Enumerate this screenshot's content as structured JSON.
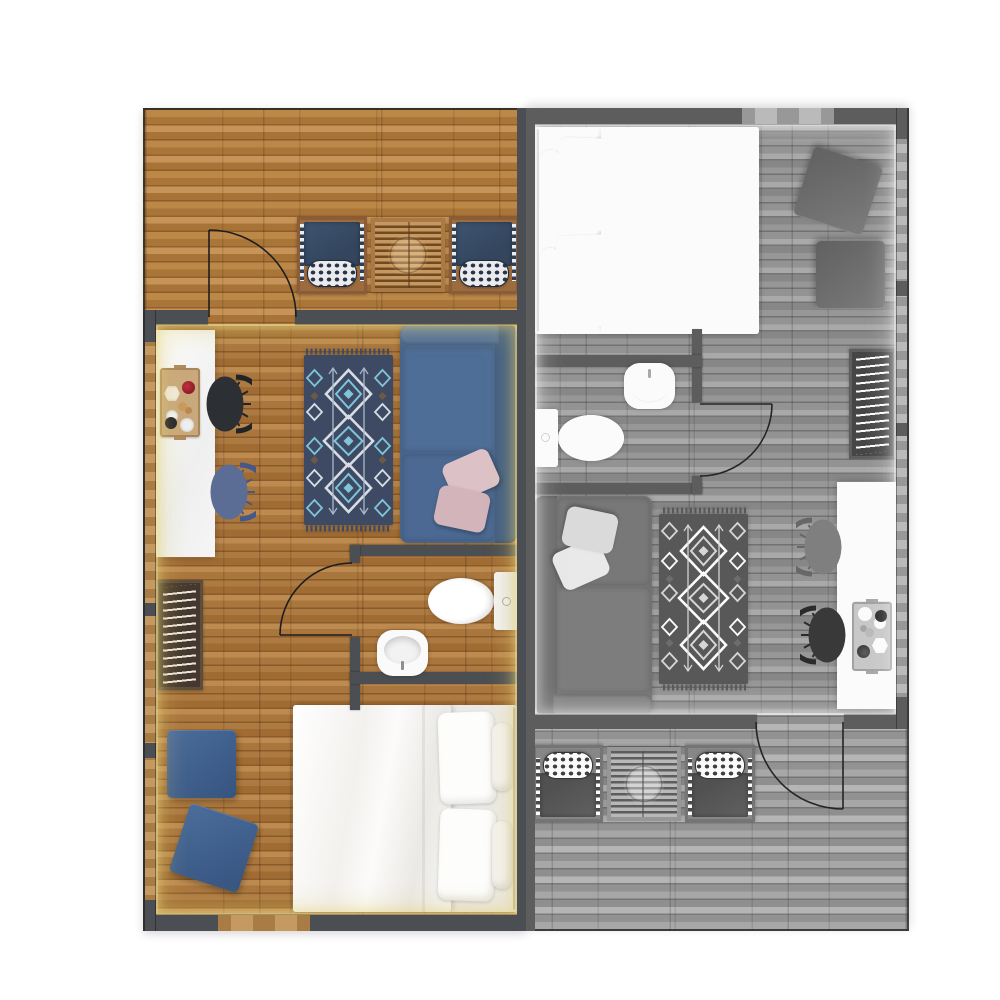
{
  "meta": {
    "title": "Two-unit apartment floor plan",
    "view": "top-down architectural render",
    "units_count": 2
  },
  "units": [
    {
      "id": "unit-a",
      "position": "left",
      "palette": "color",
      "rooms": [
        {
          "name": "terrace",
          "furniture": [
            "lounge chair with navy cushion",
            "slatted wood side table",
            "lounge chair with navy cushion"
          ],
          "features": [
            "swing door to living room"
          ]
        },
        {
          "name": "living-kitchen",
          "furniture": [
            "white kitchen island",
            "wood serving tray with dishes",
            "dark dining chair",
            "blue dining chair",
            "navy kilim area rug",
            "blue two-seat sofa",
            "two blush throw pillows"
          ]
        },
        {
          "name": "hall",
          "furniture": [
            "ladder rack"
          ]
        },
        {
          "name": "bathroom",
          "furniture": [
            "toilet",
            "washbasin"
          ],
          "features": [
            "swing door from hall"
          ]
        },
        {
          "name": "bedroom",
          "furniture": [
            "double bed with white bedding and four pillows",
            "blue square pouf",
            "blue square pouf rotated"
          ],
          "features": [
            "window in bottom wall"
          ]
        }
      ]
    },
    {
      "id": "unit-b",
      "position": "right",
      "palette": "grayscale",
      "transform": "identical plan rotated 180 degrees",
      "rooms": "same as unit-a (mirrored)"
    }
  ],
  "colors": {
    "wall": "#4b4e52",
    "wall-glow": "#e6d387",
    "floor-wood": "#ad7a42",
    "deck-wood": "#b98547",
    "window-tan": "#b8905c",
    "frame-wood": "#8a5c38",
    "cushion-navy": "#33465e",
    "sofa-blue": "#47648a",
    "rug-navy": "#3e4a63",
    "rug-accent": "#7fc5da",
    "rug-light": "#d7dde4",
    "pillow-pink": "#dcc2c6",
    "pouf-blue": "#40608d",
    "chair-dark": "#2c2f33",
    "chair-blue": "#5b6c95",
    "island-white": "#f5f5f5",
    "porcelain": "#fafafa",
    "bedding-white": "#f6f5f3",
    "tray-wood": "#c9a87b",
    "outline": "#1d1d1d"
  }
}
